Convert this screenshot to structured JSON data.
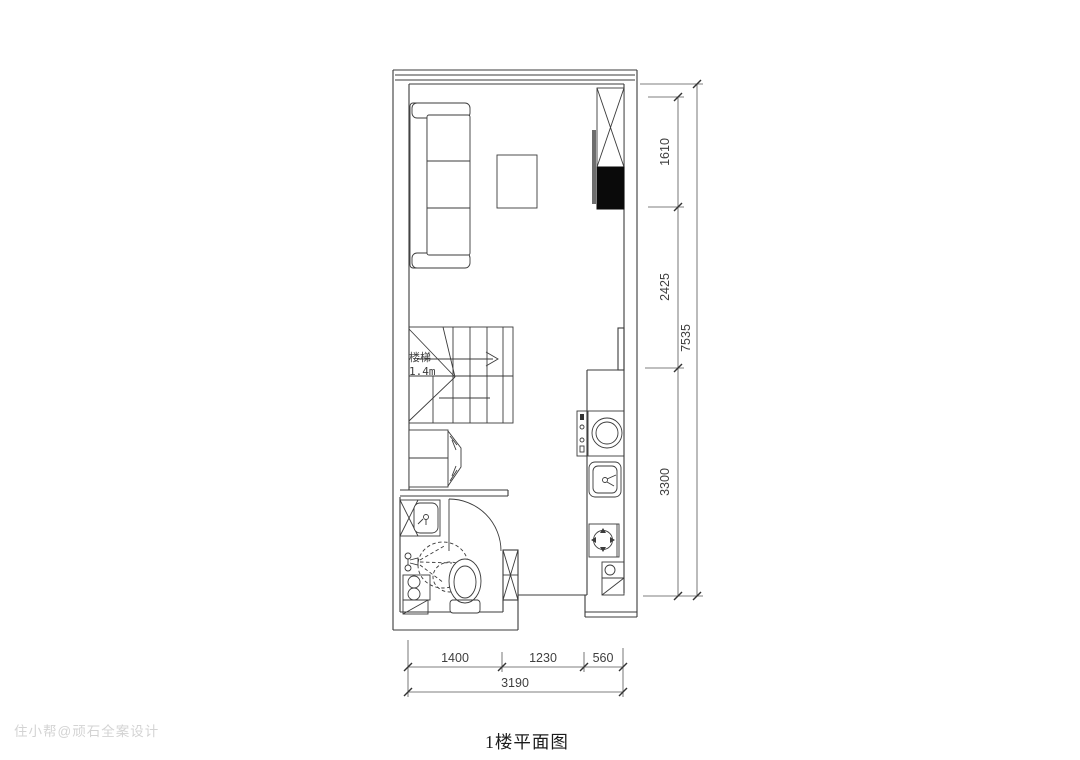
{
  "title": "1楼平面图",
  "watermark": "住小帮@顽石全案设计",
  "stairs": {
    "label": "楼梯",
    "size": "1.4m"
  },
  "dimensions": {
    "right": {
      "seg1": "1610",
      "seg2": "2425",
      "seg3": "3300",
      "total": "7535"
    },
    "bottom": {
      "seg1": "1400",
      "seg2": "1230",
      "seg3": "560",
      "total": "3190"
    }
  },
  "colors": {
    "line": "#3b3b3b",
    "dimension": "#555555",
    "tv_fill": "#0a0a0a",
    "panel_fill": "#6e6e6e",
    "watermark": "#c9c9c9"
  }
}
